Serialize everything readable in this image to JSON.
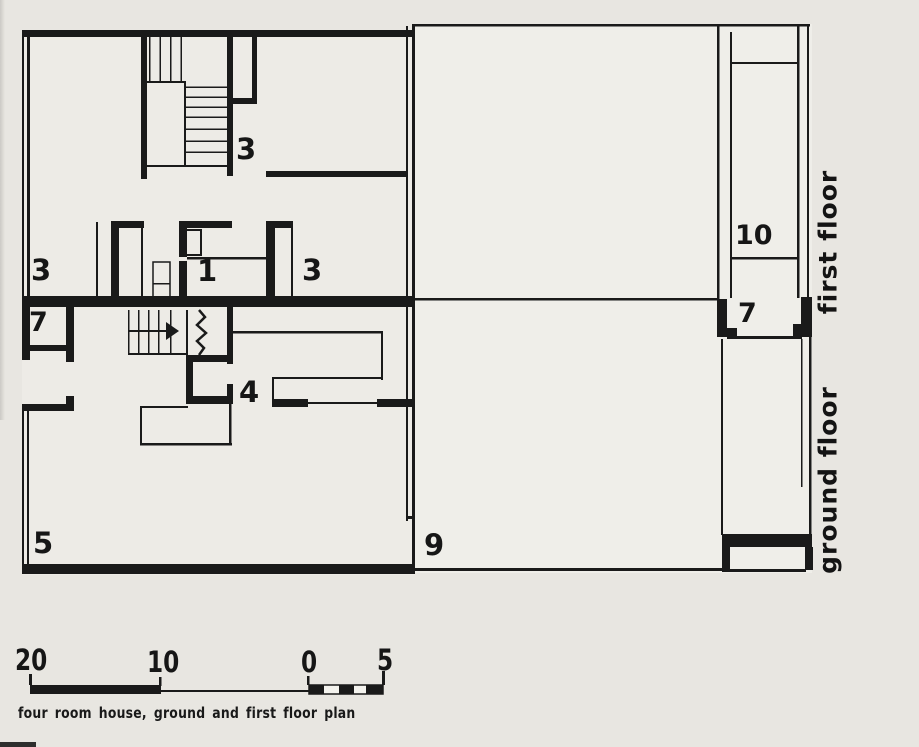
{
  "colors": {
    "paper": "#e8e6e1",
    "ink": "#1a1a1a"
  },
  "floors": {
    "first": "first floor",
    "ground": "ground floor"
  },
  "rooms": {
    "ff_3_top": "3",
    "ff_3_left": "3",
    "ff_1": "1",
    "ff_3_right": "3",
    "ff_10": "10",
    "gf_7_left": "7",
    "gf_4": "4",
    "gf_5": "5",
    "gf_9": "9",
    "gf_7_right": "7"
  },
  "scale_bar": {
    "labels": [
      "20",
      "10",
      "0",
      "5"
    ]
  },
  "caption": "four room house, ground and first floor plan"
}
